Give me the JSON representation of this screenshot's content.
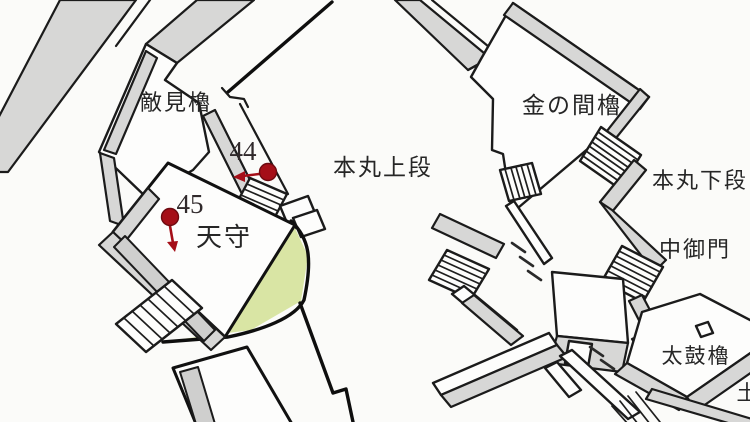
{
  "map": {
    "description": "Hand-drawn isometric plan of a Japanese castle main bailey (honmaru) with numbered survey markers",
    "labels": {
      "tekimi_yagura": "敵見櫓",
      "honmaru_upper": "本丸上段",
      "kin_no_ma_yagura": "金の間櫓",
      "honmaru_lower": "本丸下段",
      "naka_gomon": "中御門",
      "tenshu": "天守",
      "taiko_yagura": "太鼓櫓",
      "edge_partial": "土"
    },
    "markers": {
      "m44": {
        "label": "44"
      },
      "m45": {
        "label": "45"
      }
    },
    "colors": {
      "background": "#fbfbf9",
      "wall_fill": "#d7d7d6",
      "line_ink": "#1b1b1b",
      "ground_green": "#d9e5a4",
      "marker_red": "#a50f18"
    }
  }
}
